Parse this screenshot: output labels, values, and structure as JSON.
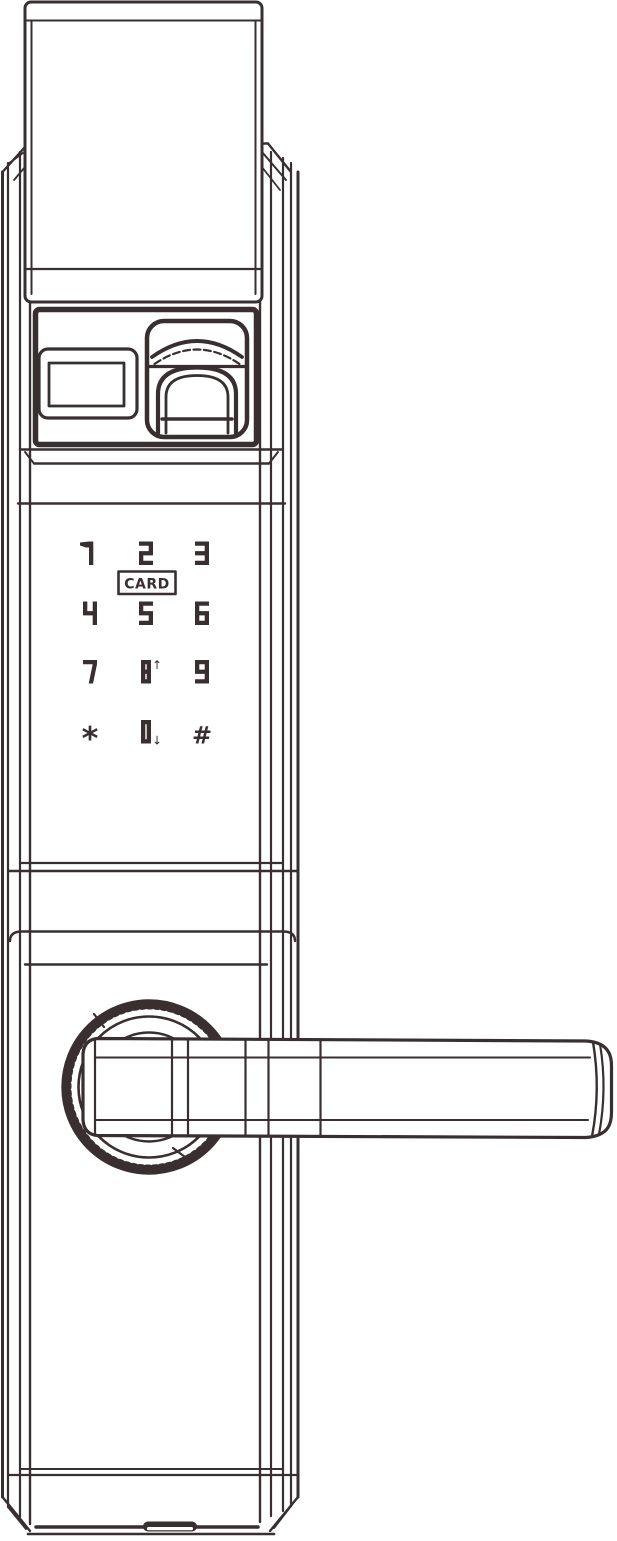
{
  "colors": {
    "line_color": "#392f31",
    "background": "#ffffff"
  },
  "keypad": {
    "card_label": "CARD",
    "keys": [
      {
        "id": "key-1",
        "label": "1",
        "type": "digit",
        "row": 0,
        "col": 0
      },
      {
        "id": "key-2",
        "label": "2",
        "type": "digit",
        "row": 0,
        "col": 1
      },
      {
        "id": "key-3",
        "label": "3",
        "type": "digit",
        "row": 0,
        "col": 2
      },
      {
        "id": "key-4",
        "label": "4",
        "type": "digit",
        "row": 1,
        "col": 0
      },
      {
        "id": "key-5",
        "label": "5",
        "type": "digit",
        "row": 1,
        "col": 1
      },
      {
        "id": "key-6",
        "label": "6",
        "type": "digit",
        "row": 1,
        "col": 2
      },
      {
        "id": "key-7",
        "label": "7",
        "type": "digit",
        "row": 2,
        "col": 0
      },
      {
        "id": "key-8",
        "label": "8",
        "type": "digit",
        "row": 2,
        "col": 1,
        "suffix": "↑"
      },
      {
        "id": "key-9",
        "label": "9",
        "type": "digit",
        "row": 2,
        "col": 2
      },
      {
        "id": "key-star",
        "label": "*",
        "type": "symbol",
        "row": 3,
        "col": 0
      },
      {
        "id": "key-0",
        "label": "0",
        "type": "digit",
        "row": 3,
        "col": 1,
        "suffix": "↓"
      },
      {
        "id": "key-hash",
        "label": "#",
        "type": "symbol",
        "row": 3,
        "col": 2
      }
    ]
  }
}
